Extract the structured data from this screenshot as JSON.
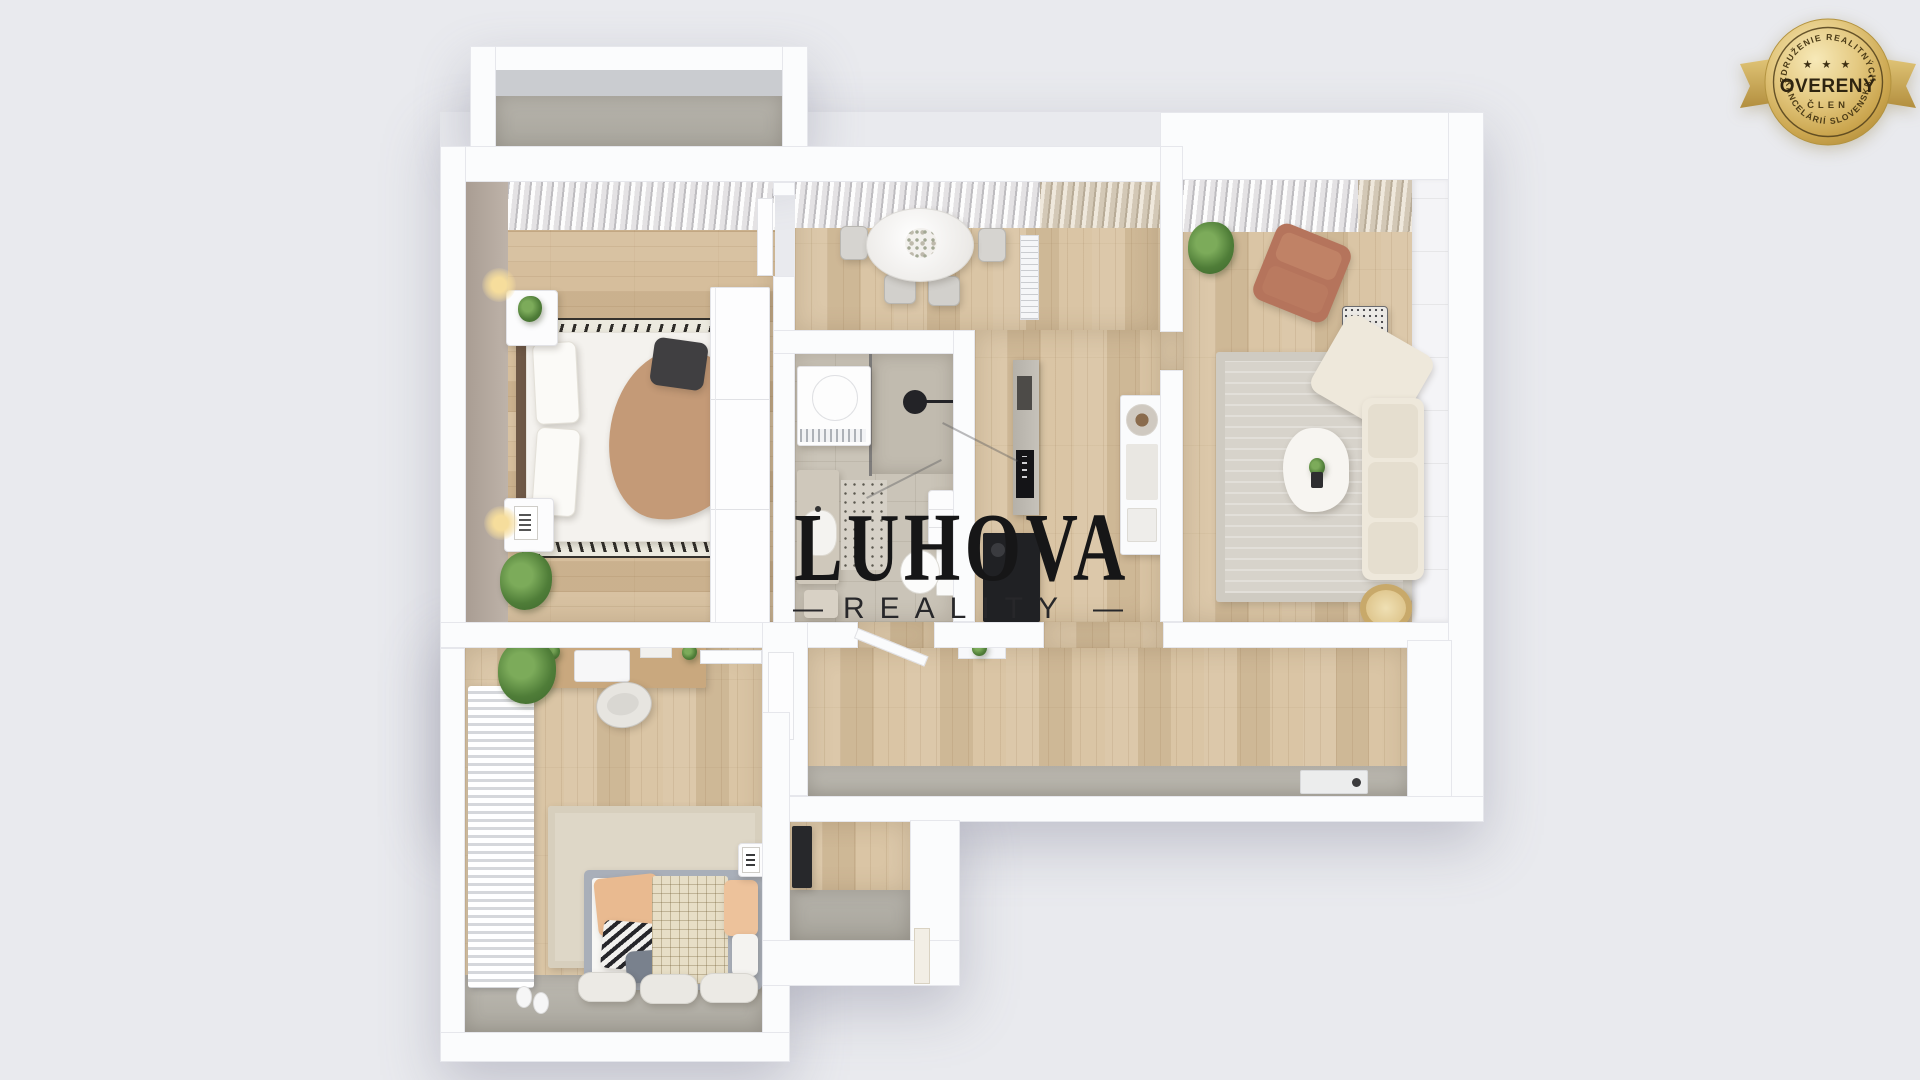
{
  "watermark": {
    "title": "LUHOVA",
    "subtitle": "REALITY",
    "dash": "—"
  },
  "badge": {
    "arc_top": "ZDRUŽENIE REALITNÝCH",
    "arc_bottom": "KANCELÁRIÍ SLOVENSKA",
    "stars": "★ ★ ★",
    "title": "OVERENÝ",
    "member": "ČLEN"
  },
  "palette": {
    "background": "#e9eaee",
    "wall": "#fbfcfd",
    "wood_floor": "#d8c2a0",
    "tile_floor": "#cac4b8",
    "concrete": "#a7a49b",
    "watermark_text": "#161617",
    "badge_gold": "#d9b96a",
    "badge_text": "#3a2d12",
    "sofa_beige": "#eee8db",
    "armchair_terracotta": "#b5745c",
    "kitchen_black": "#202124"
  }
}
